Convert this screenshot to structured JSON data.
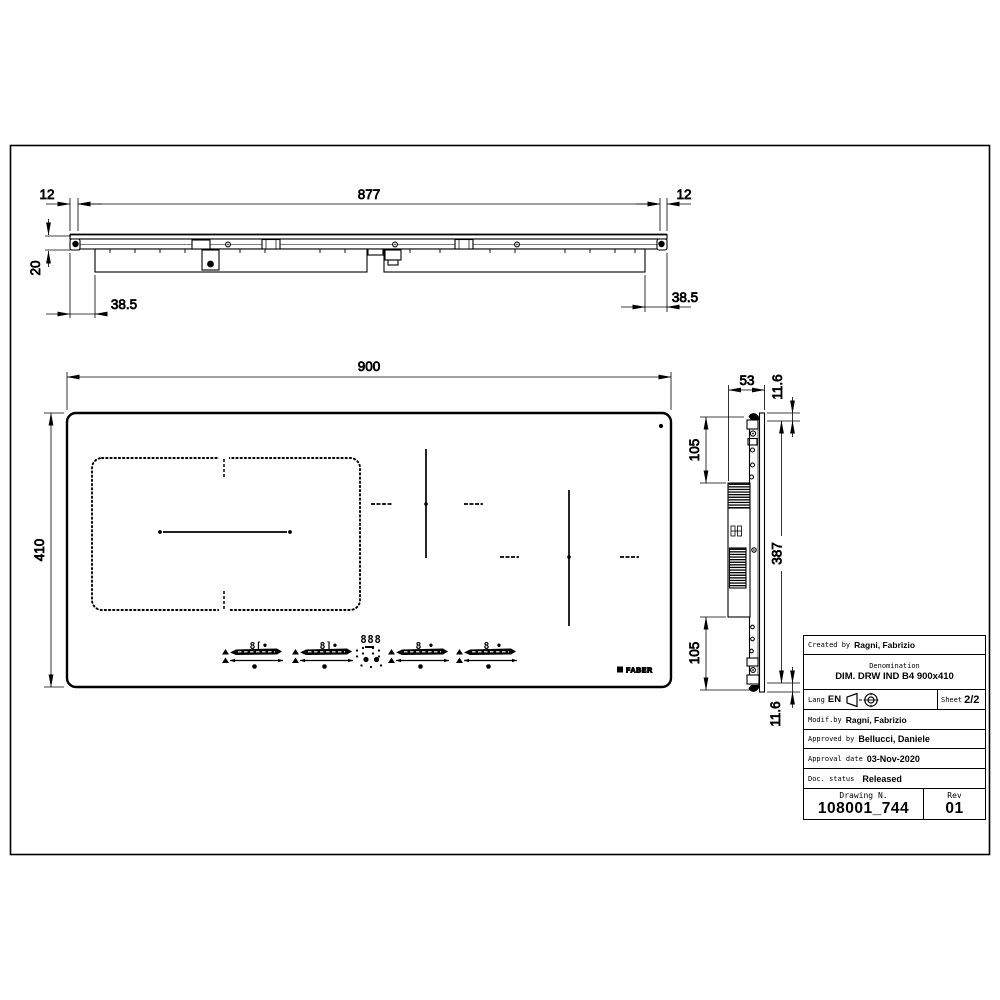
{
  "front_view": {
    "dim_left_overhang": "12",
    "dim_glass_width": "877",
    "dim_right_overhang": "12",
    "dim_height": "20",
    "dim_left_inset": "38.5",
    "dim_right_inset": "38.5"
  },
  "plan_view": {
    "dim_width": "900",
    "dim_height": "410",
    "brand": "FABER",
    "controls": {
      "zone1_display": "8[•",
      "zone2_display": "8]•",
      "timer_display": "888",
      "zone3_display": "8 •",
      "zone4_display": "8 •"
    }
  },
  "side_view": {
    "dim_depth": "53",
    "dim_top_glass": "11.6",
    "dim_top_inset": "105",
    "dim_body_height": "387",
    "dim_bottom_inset": "105",
    "dim_bottom_glass": "11.6"
  },
  "title_block": {
    "created_by_label": "Created by",
    "created_by": "Ragni, Fabrizio",
    "denomination_label": "Denomination",
    "denomination": "DIM. DRW IND B4 900x410",
    "lang_label": "Lang",
    "lang_value": "EN",
    "sheet_label": "Sheet",
    "sheet_value": "2/2",
    "modif_by_label": "Modif.by",
    "modif_by": "Ragni, Fabrizio",
    "approved_by_label": "Approved by",
    "approved_by": "Bellucci, Daniele",
    "approval_date_label": "Approval date",
    "approval_date": "03-Nov-2020",
    "doc_status_label": "Doc. status",
    "doc_status": "Released",
    "drawing_n_label": "Drawing N.",
    "drawing_n": "108001_744",
    "rev_label": "Rev",
    "rev": "01"
  }
}
